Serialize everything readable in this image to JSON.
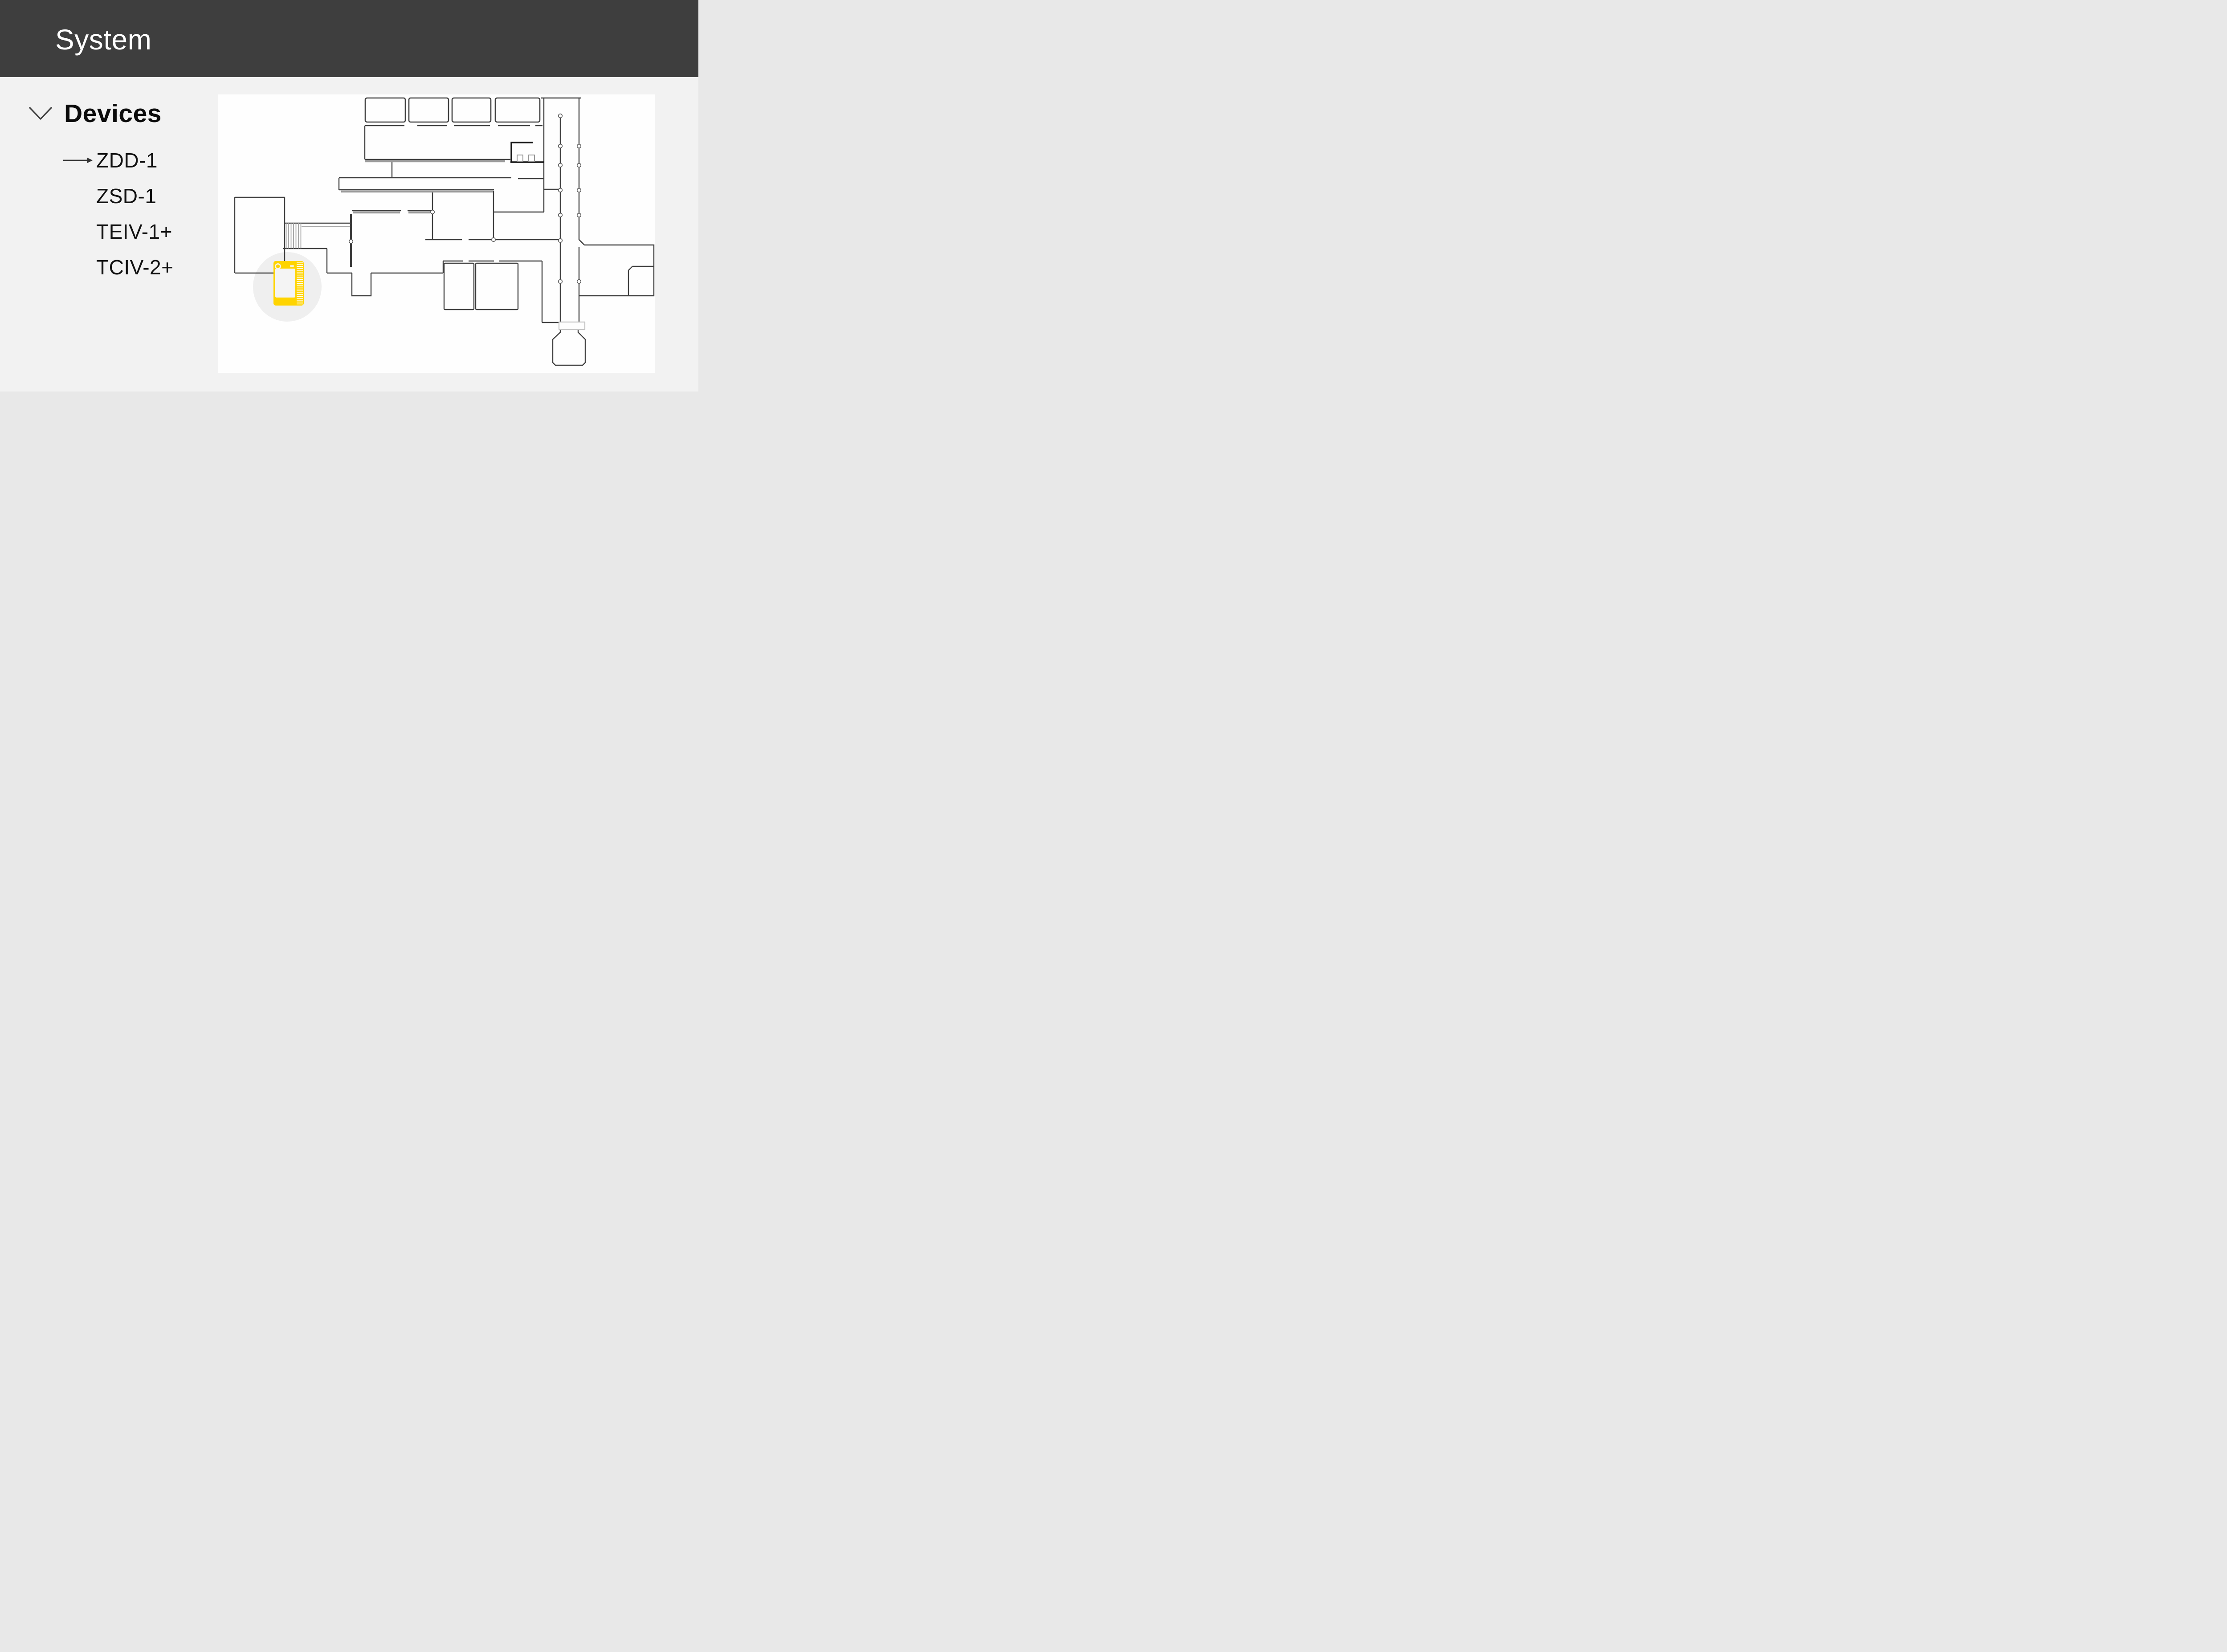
{
  "header": {
    "title": "System",
    "bg_color": "#3E3E3E"
  },
  "sidebar": {
    "section": {
      "label": "Devices",
      "expanded": true,
      "icon": "chevron-down-icon"
    },
    "items": [
      {
        "label": "ZDD-1",
        "selected": true,
        "indicator": "arrow-right-icon"
      },
      {
        "label": "ZSD-1",
        "selected": false,
        "indicator": null
      },
      {
        "label": "TEIV-1+",
        "selected": false,
        "indicator": null
      },
      {
        "label": "TCIV-2+",
        "selected": false,
        "indicator": null
      }
    ],
    "selected_item": "ZDD-1"
  },
  "floorplan": {
    "kind": "building floor plan",
    "device_marker": {
      "device": "ZDD-1",
      "icon": "smart-panel-device-icon",
      "color": "#FFD400",
      "halo_color": "#EFEFEF"
    },
    "colors": {
      "background": "#FEFEFE",
      "wall_dark": "#3F3F3F",
      "wall_gray": "#999999",
      "wall_light": "#C4C4C4",
      "door_node_fill": "#FFFFFF"
    }
  }
}
